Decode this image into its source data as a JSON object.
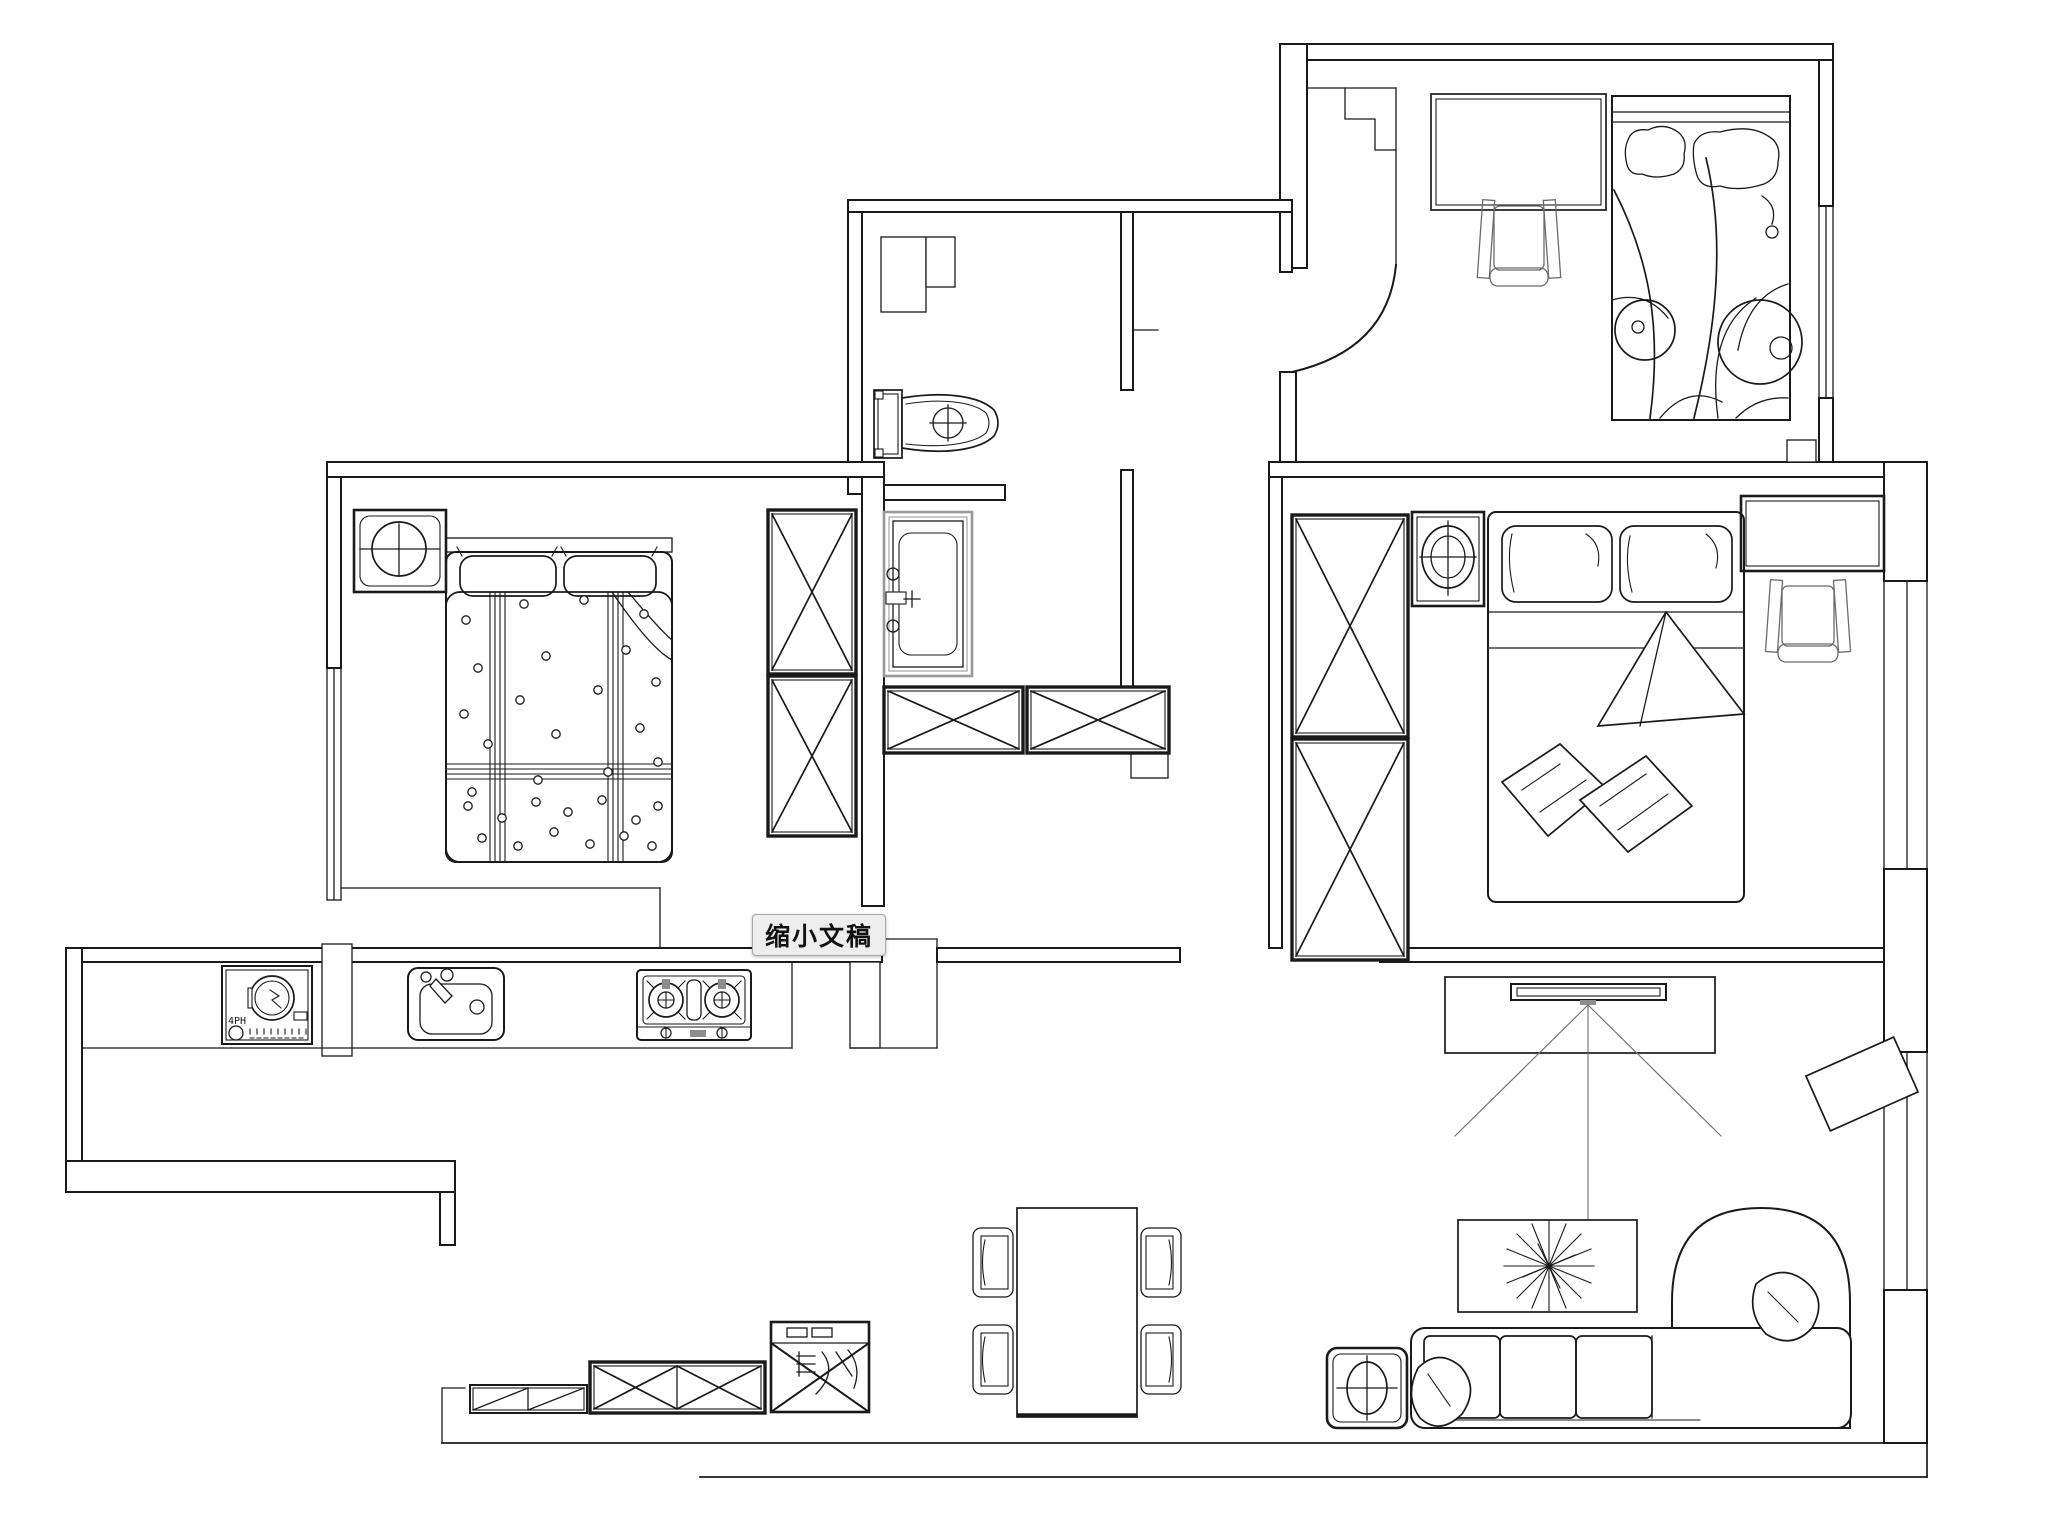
{
  "app": {
    "tooltip": {
      "label": "缩小文稿"
    }
  },
  "theme": {
    "background": "#ffffff",
    "line": "#1a1a1a",
    "line_soft": "#6b6b6b",
    "tub_outline": "#9a9a9a",
    "tooltip_bg": "#ededed",
    "tooltip_border": "#a8a8a8",
    "tooltip_text": "#111111"
  },
  "labels": {
    "washing_machine_model": "4PH"
  },
  "floor_plan": {
    "type": "apartment-floor-plan",
    "style": "CAD black line work on white",
    "rooms": [
      {
        "name": "bedroom-top-right",
        "furniture": [
          "desk",
          "desk-chair",
          "single-bed-swirl-blanket"
        ]
      },
      {
        "name": "bedroom-left",
        "furniture": [
          "lamp-side-table",
          "double-bed-dotted-plaid",
          "wardrobe-two-x"
        ]
      },
      {
        "name": "bathroom",
        "furniture": [
          "toilet",
          "bathtub",
          "half-wall"
        ]
      },
      {
        "name": "hallway",
        "furniture": [
          "storage-cabinet-x",
          "storage-cabinet-x",
          "curved-entry-wall"
        ]
      },
      {
        "name": "bedroom-right-master",
        "furniture": [
          "wardrobe-two-x",
          "lamp-nightstand",
          "double-bed-pillows-cushions",
          "desk",
          "desk-chair"
        ]
      },
      {
        "name": "kitchen",
        "furniture": [
          "washing-machine",
          "kitchen-sink",
          "gas-stove-two-burner",
          "counter"
        ]
      },
      {
        "name": "dining-area",
        "furniture": [
          "dining-table",
          "dining-chair",
          "dining-chair",
          "dining-chair",
          "dining-chair"
        ]
      },
      {
        "name": "living-room",
        "furniture": [
          "tv-cabinet",
          "tv-with-sightlines",
          "rotated-rug-panel",
          "coffee-table-with-plant",
          "l-shaped-sofa",
          "lamp-side-table",
          "low-sideboard-diagonal",
          "sideboard-two-x",
          "appliance-cabinet-with-marking"
        ]
      }
    ],
    "windows": [
      "left-bedroom-west",
      "top-right-bedroom-east",
      "master-bedroom-east",
      "living-room-east"
    ]
  }
}
